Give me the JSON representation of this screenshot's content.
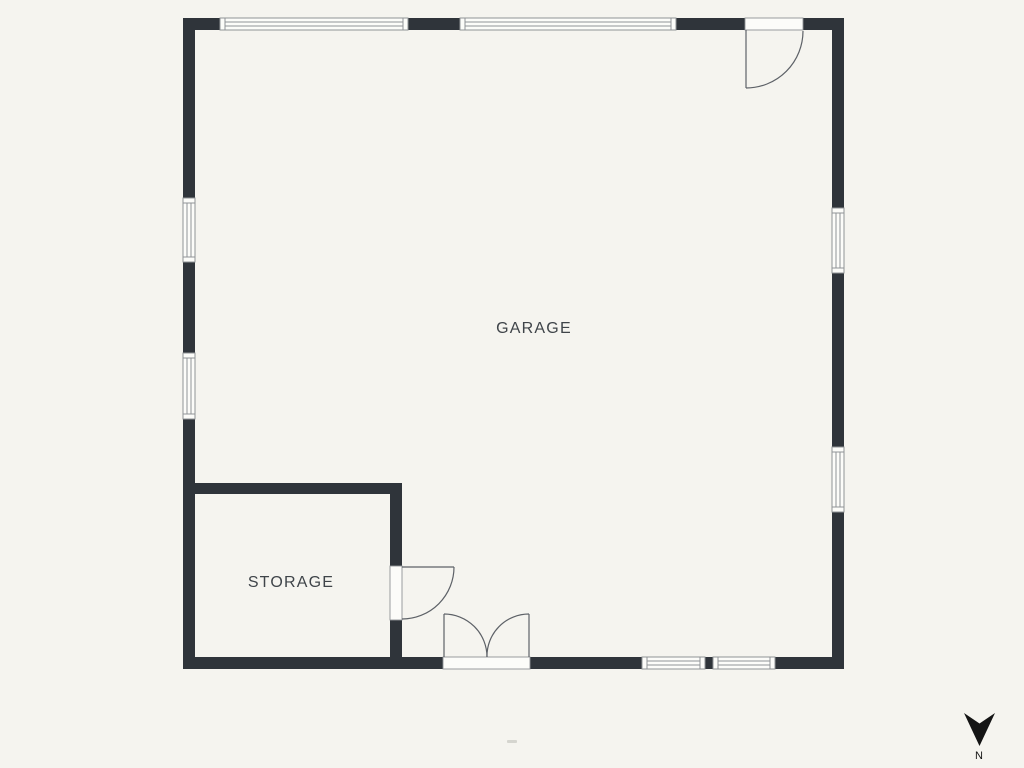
{
  "colors": {
    "background": "#f5f4ef",
    "wall": "#2f343a",
    "paper": "#fcfcf9",
    "frame": "#909396",
    "door": "#5d6167",
    "label": "#3f4449",
    "compass": "#141414"
  },
  "rooms": {
    "garage": {
      "label": "GARAGE"
    },
    "storage": {
      "label": "STORAGE"
    }
  },
  "compass": {
    "label": "N",
    "direction": "down"
  },
  "fixtures": {
    "entry_door": "single swing door, top-right, opens into garage",
    "storage_door": "single swing door, storage to garage",
    "double_door": "double swing door, bottom center",
    "window_count": 8
  },
  "watermark": "·"
}
